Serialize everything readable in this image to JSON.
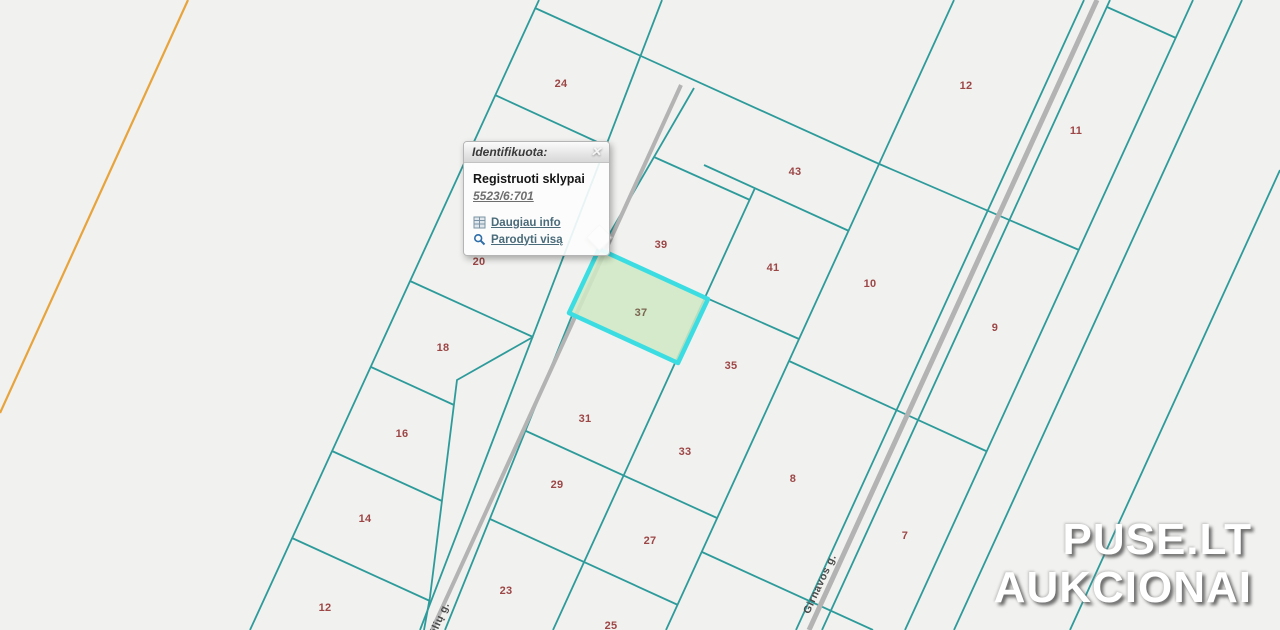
{
  "map": {
    "colors": {
      "background": "#f1f1ef",
      "parcel_line": "#2e9b9b",
      "road": "#b3b3b3",
      "boundary_orange": "#e8a43c",
      "parcel_label": "#9c4646",
      "highlight_fill": "#cfe9c3",
      "highlight_stroke": "#3cdde2"
    },
    "parcels": [
      {
        "label": "24",
        "x": 561,
        "y": 84
      },
      {
        "label": "20",
        "x": 479,
        "y": 262
      },
      {
        "label": "18",
        "x": 443,
        "y": 348
      },
      {
        "label": "16",
        "x": 402,
        "y": 434
      },
      {
        "label": "14",
        "x": 365,
        "y": 519
      },
      {
        "label": "12",
        "x": 325,
        "y": 608
      },
      {
        "label": "39",
        "x": 661,
        "y": 245
      },
      {
        "label": "37",
        "x": 641,
        "y": 313
      },
      {
        "label": "31",
        "x": 585,
        "y": 419
      },
      {
        "label": "29",
        "x": 557,
        "y": 485
      },
      {
        "label": "23",
        "x": 506,
        "y": 591
      },
      {
        "label": "25",
        "x": 611,
        "y": 626
      },
      {
        "label": "41",
        "x": 773,
        "y": 268
      },
      {
        "label": "35",
        "x": 731,
        "y": 366
      },
      {
        "label": "33",
        "x": 685,
        "y": 452
      },
      {
        "label": "27",
        "x": 650,
        "y": 541
      },
      {
        "label": "43",
        "x": 795,
        "y": 172
      },
      {
        "label": "12",
        "x": 966,
        "y": 86
      },
      {
        "label": "10",
        "x": 870,
        "y": 284
      },
      {
        "label": "8",
        "x": 793,
        "y": 479
      },
      {
        "label": "11",
        "x": 1076,
        "y": 131
      },
      {
        "label": "9",
        "x": 995,
        "y": 328
      },
      {
        "label": "7",
        "x": 905,
        "y": 536
      }
    ],
    "highlighted_parcel": "37",
    "streets": [
      {
        "name": "Girnavos g."
      },
      {
        "name": "ndėlių g."
      }
    ]
  },
  "popup": {
    "title": "Identifikuota:",
    "close_label": "✕",
    "layer_name": "Registruoti sklypai",
    "feature_id": "5523/6:701",
    "links": [
      {
        "label": "Daugiau info"
      },
      {
        "label": "Parodyti visą"
      }
    ]
  },
  "watermark": {
    "line1": "PUSE.LT",
    "line2": "AUKCIONAI"
  }
}
